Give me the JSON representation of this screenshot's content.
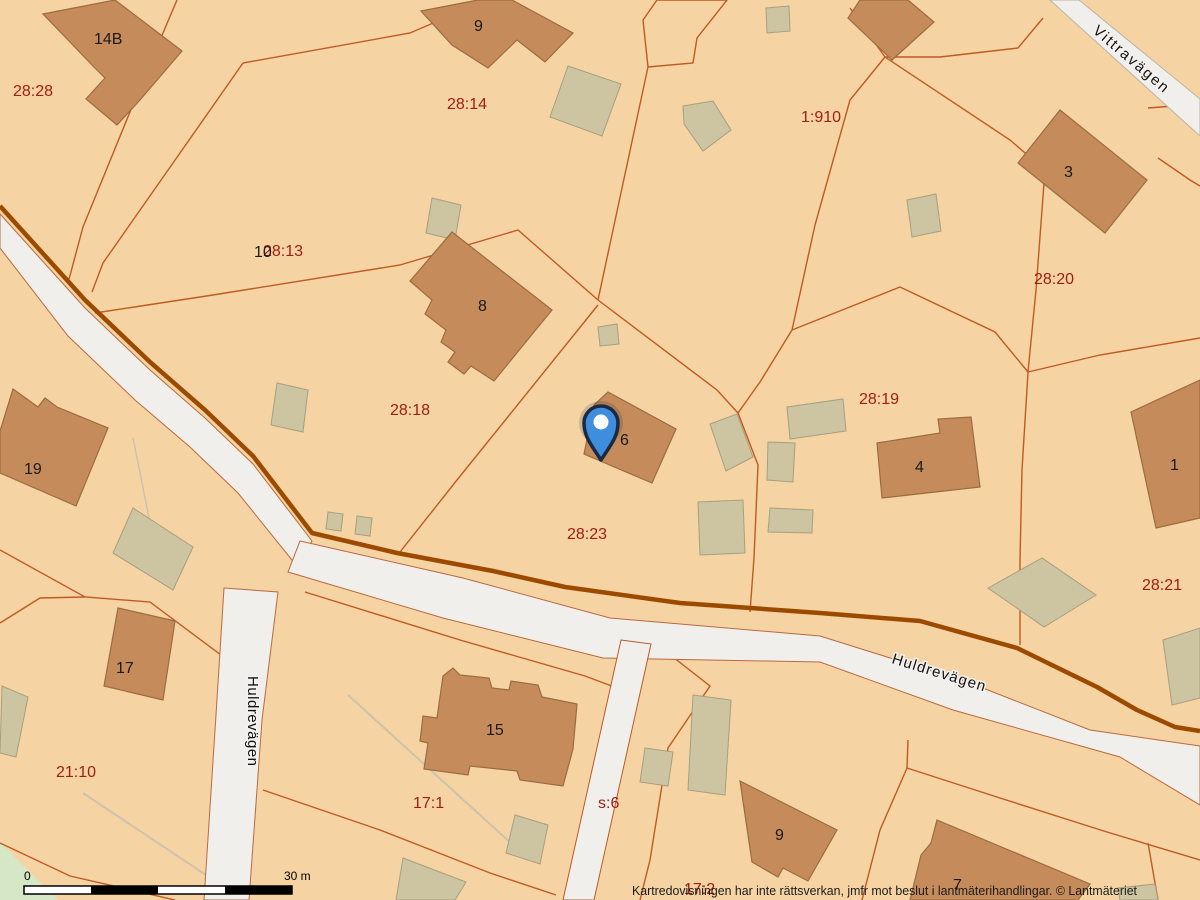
{
  "map": {
    "parcels": [
      "28:28",
      "28:14",
      "1:910",
      "28:13",
      "28:20",
      "28:18",
      "28:19",
      "28:23",
      "28:21",
      "21:10",
      "17:1",
      "s:6",
      "17:2"
    ],
    "house_numbers": [
      "14B",
      "9",
      "8",
      "6",
      "3",
      "4",
      "1",
      "19",
      "17",
      "15",
      "9",
      "7",
      "10"
    ],
    "streets": [
      "Vittravägen",
      "Huldrevägen",
      "Huldrevägen"
    ],
    "marker": {
      "icon": "location-pin"
    },
    "scalebar": {
      "min": "0",
      "max": "30 m"
    },
    "attribution": "Kartredovisningen har inte rättsverkan, jmfr mot beslut i lantmäterihandlingar. © Lantmäteriet",
    "colors": {
      "background": "#f5d3a2",
      "parcel_line": "#c05a24",
      "main_road_edge": "#9c4a00",
      "road_fill": "#f1efec",
      "building_fill": "#c58b5a",
      "building_stroke": "#9c6c40",
      "outbuilding_fill": "#cdc5a2",
      "outbuilding_stroke": "#a89f7f",
      "parcel_label": "#9e2013",
      "house_label": "#1a1a1a",
      "green_area": "#d5e7c4",
      "marker_fill": "#3f8ede",
      "marker_outline": "#1b2a44"
    }
  }
}
